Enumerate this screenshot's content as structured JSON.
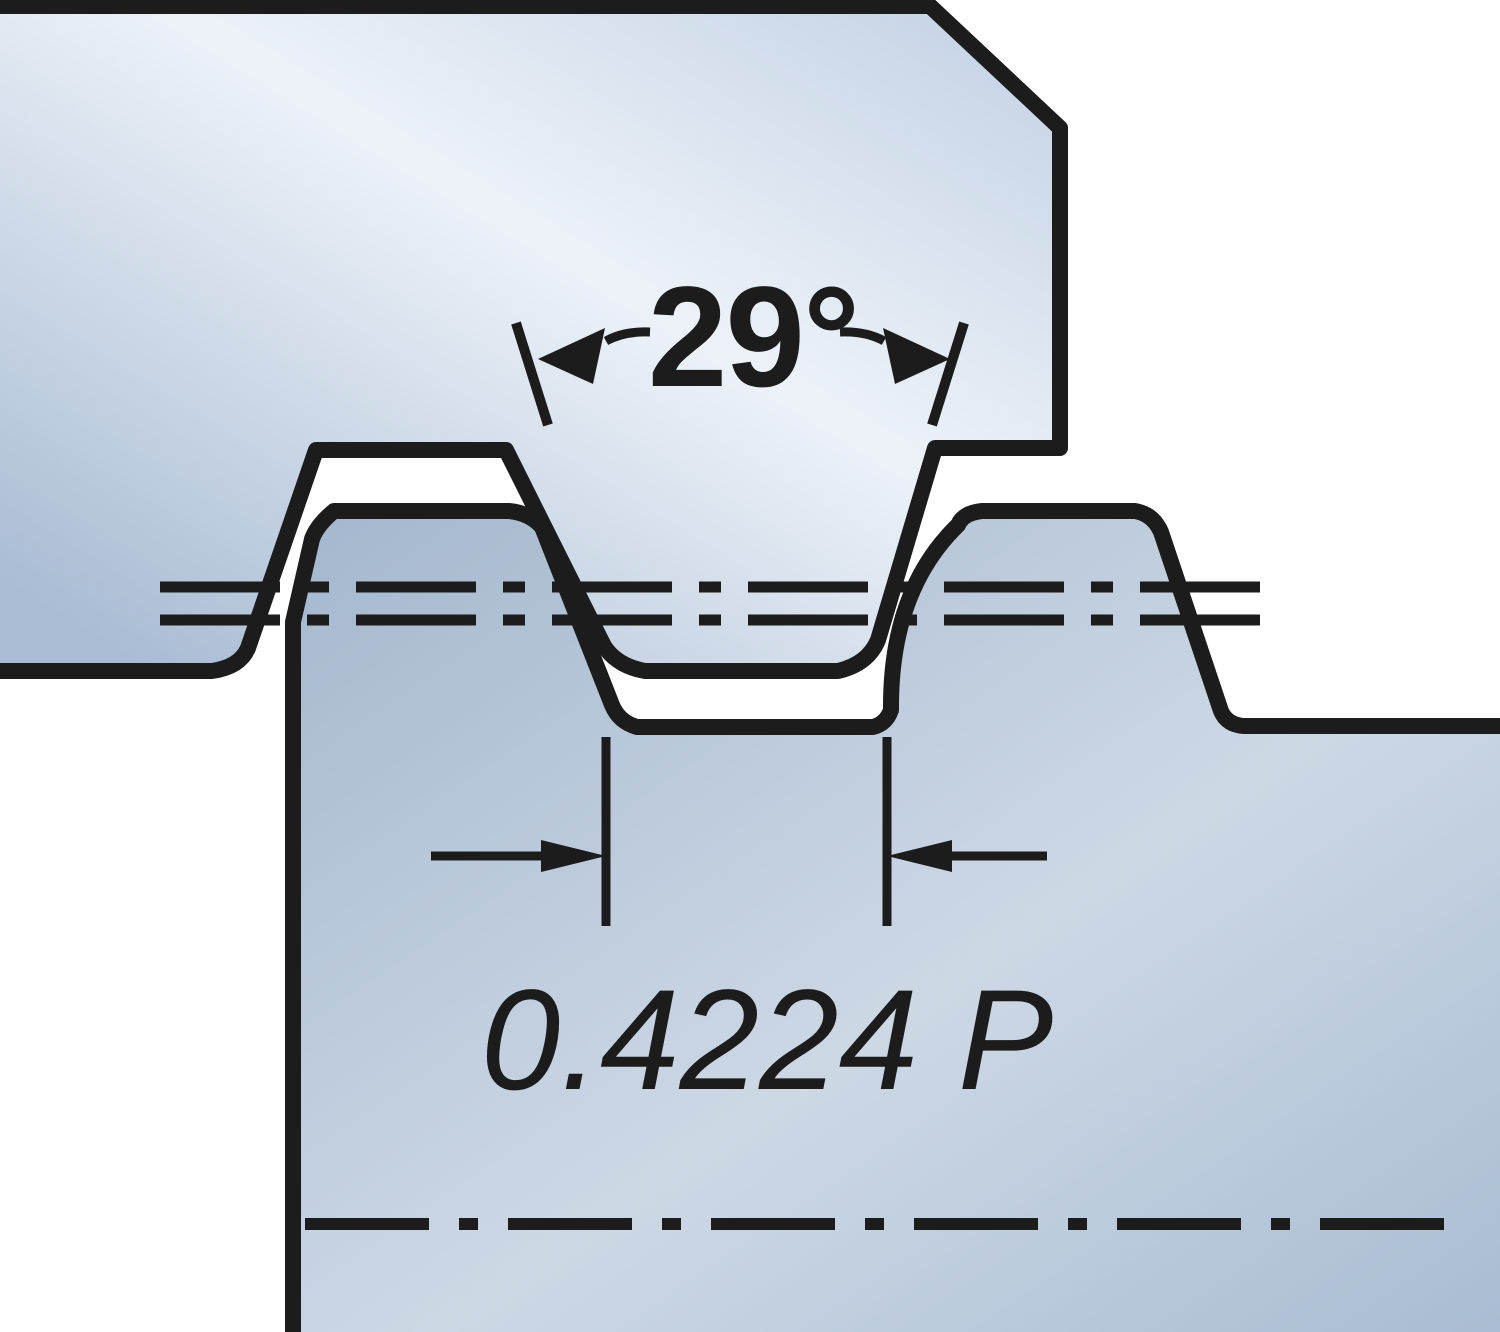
{
  "diagram": {
    "type": "technical-drawing",
    "subject": "Trapezoidal (ACME) thread profile: tool insert engaged in workpiece thread groove",
    "labels": {
      "thread_angle": "29°",
      "root_width": "0.4224 P"
    },
    "colors": {
      "line": "#1c1c1c",
      "background": "#ffffff",
      "tool_fill_dark": "#a9bcd4",
      "tool_fill_light": "#edf2f8",
      "tool_fill_edge": "#c9d6e7",
      "work_fill_dark": "#a4b7ce",
      "work_fill_light": "#cdd8e5",
      "work_fill_corner": "#a7bbd2"
    }
  }
}
